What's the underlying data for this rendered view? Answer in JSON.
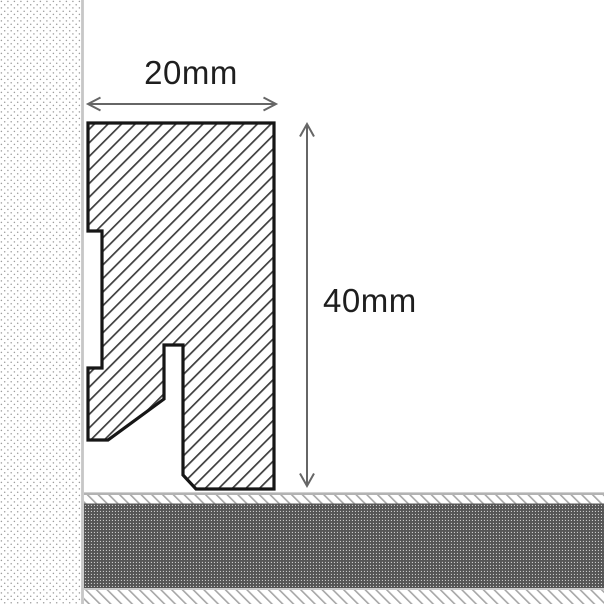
{
  "labels": {
    "width": "20mm",
    "height": "40mm"
  },
  "colors": {
    "background": "#ffffff",
    "profile_outline": "#161616",
    "profile_hatch_line": "#3d3d3d",
    "wall_dot": "#9c9c9c",
    "wall_edge": "#c7c7c7",
    "floor_top_border": "#b3b3b3",
    "floor_hatch_line": "#a6a6a6",
    "floor_core_dark": "#555555",
    "floor_core_speck": "#c8c8c8",
    "floor_divider": "#c9c9c9",
    "dimension_gray": "#666666",
    "label_text": "#1e1e1e"
  }
}
